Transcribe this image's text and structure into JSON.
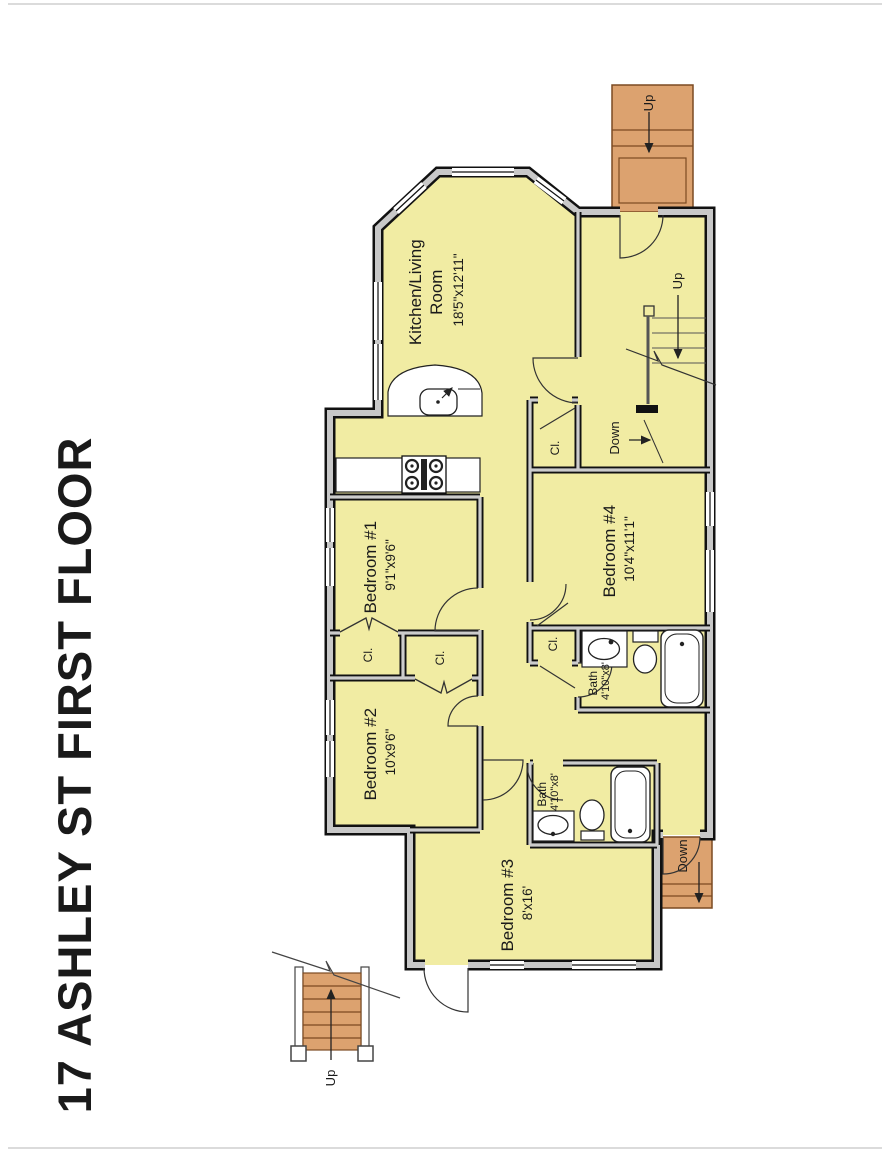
{
  "title": "17 ASHLEY ST FIRST FLOOR",
  "colors": {
    "floor": "#f1eca3",
    "stairs": "#dca26f",
    "wall_core": "#c8c8c8",
    "wall_edge": "#111111"
  },
  "rooms": {
    "kitchen_living": {
      "name_line1": "Kitchen/Living",
      "name_line2": "Room",
      "dims": "18'5\"x12'11\""
    },
    "bedroom1": {
      "name": "Bedroom #1",
      "dims": "9'1\"x9'6\""
    },
    "bedroom2": {
      "name": "Bedroom #2",
      "dims": "10'x9'6\""
    },
    "bedroom3": {
      "name": "Bedroom #3",
      "dims": "8'x16'"
    },
    "bedroom4": {
      "name": "Bedroom #4",
      "dims": "10'4\"x11'1\""
    },
    "bath_upper": {
      "name": "Bath",
      "dims": "4'10\"x8'"
    },
    "bath_lower": {
      "name": "Bath",
      "dims": "4'10\"x8'"
    }
  },
  "labels": {
    "closet": "Cl.",
    "up": "Up",
    "down": "Down"
  }
}
